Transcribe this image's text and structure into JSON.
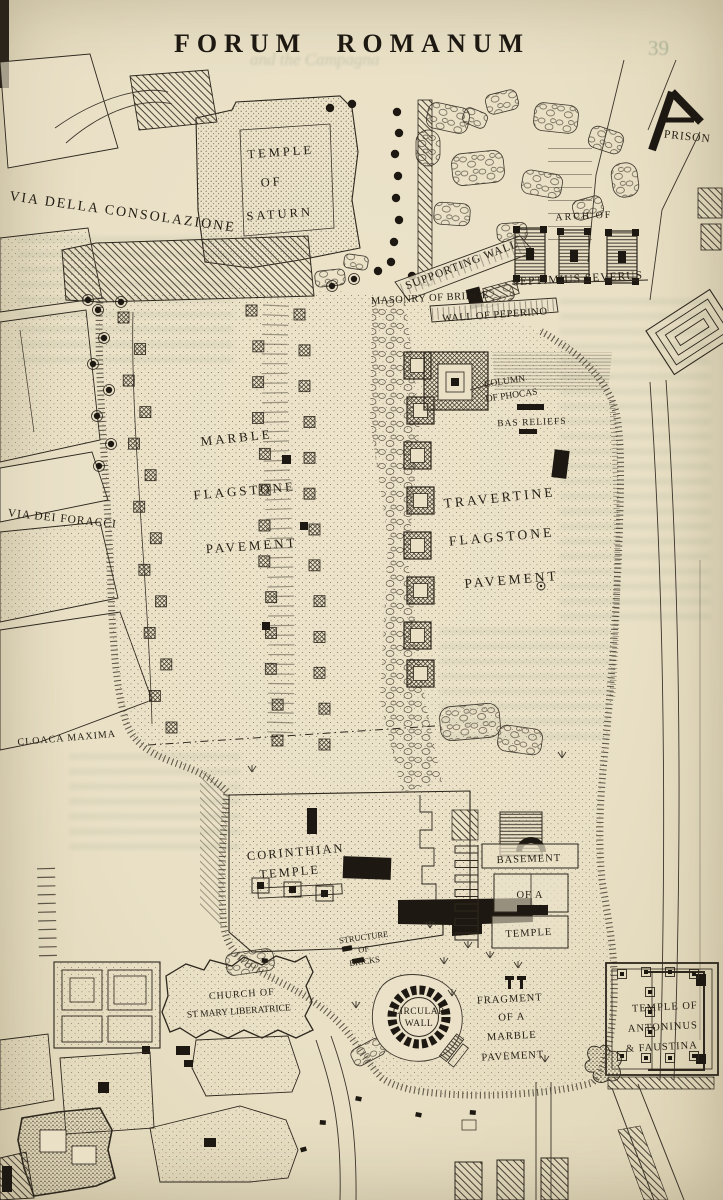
{
  "page": {
    "title": "FORUM ROMANUM",
    "bleed": {
      "page_number": "39",
      "running_title": "and the Campagna"
    }
  },
  "labels": {
    "temple_of_saturn": [
      "TEMPLE",
      "OF",
      "SATURN"
    ],
    "prison": "PRISON",
    "via_della_consolazione": "VIA DELLA CONSOLAZIONE",
    "arch_of_septimius": [
      "ARCH OF",
      "SEPTIMIUS SEVERUS"
    ],
    "supporting_wall": "SUPPORTING WALL",
    "masonry_of_bridge": "MASONRY OF BRIDGE",
    "wall_of_peperino": "WALL OF PEPERINO",
    "column_of_phocas": [
      "COLUMN",
      "OF PHOCAS"
    ],
    "bas_reliefs": "BAS RELIEFS",
    "marble_pavement": [
      "MARBLE",
      "FLAGSTONE",
      "PAVEMENT"
    ],
    "travertine_pavement": [
      "TRAVERTINE",
      "FLAGSTONE",
      "PAVEMENT"
    ],
    "via_dei_foracci": "VIA DEI FORACCI",
    "cloaca_maxima": "CLOACA MAXIMA",
    "corinthian_temple": [
      "CORINTHIAN",
      "TEMPLE"
    ],
    "structure_of_bricks": [
      "STRUCTURE",
      "OF",
      "BRICKS"
    ],
    "basement_of_a_temple": [
      "BASEMENT",
      "OF A",
      "TEMPLE"
    ],
    "church_st_mary": [
      "CHURCH OF",
      "ST MARY LIBERATRICE"
    ],
    "circular_wall": [
      "CIRCULAR",
      "WALL"
    ],
    "fragment_marble_pavement": [
      "FRAGMENT",
      "OF A",
      "MARBLE",
      "PAVEMENT"
    ],
    "temple_antoninus_faustina": [
      "TEMPLE OF",
      "ANTONINUS",
      "& FAUSTINA"
    ]
  },
  "colors": {
    "paper": "#e9e0c6",
    "ink": "#2b251b",
    "bleedthrough_green": "#8ea183"
  }
}
